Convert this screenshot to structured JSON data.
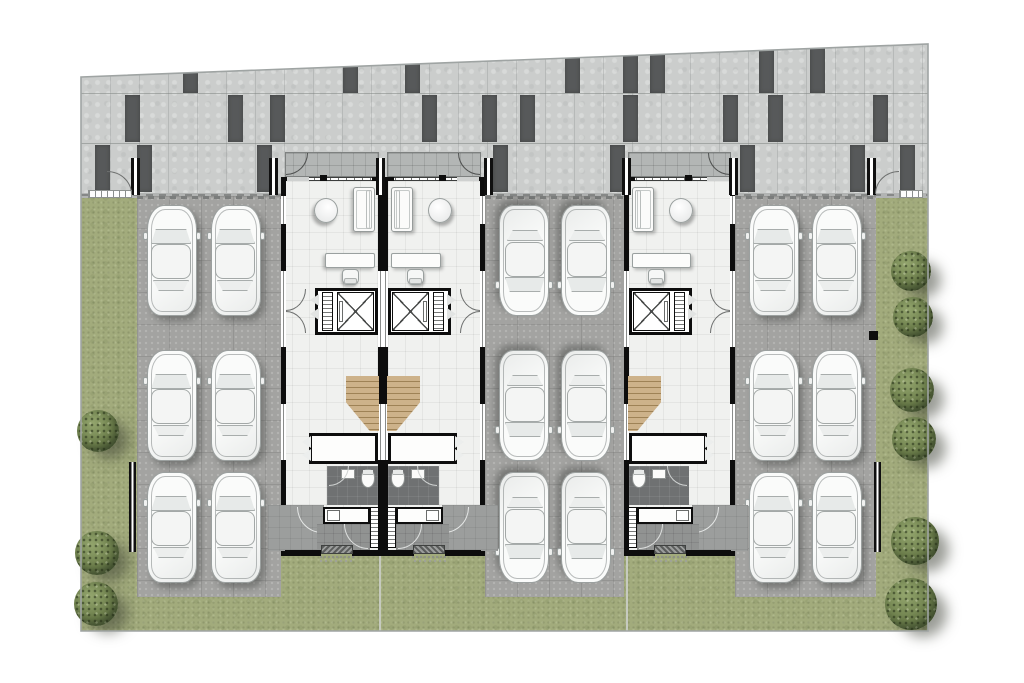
{
  "meta": {
    "title": "Townhome site plan — ground floor with parking",
    "canvas": {
      "width": 1024,
      "height": 683
    },
    "visible_text": []
  },
  "palette": {
    "page_bg": "#ffffff",
    "road": "#cbcdcc",
    "road_dash": "#57595a",
    "grass": "#a2ab7c",
    "parking_pad": "#a3a3a1",
    "building_floor": "#f0f1ef",
    "porch_band": "#b3b6b5",
    "wall_black": "#0d0d0d",
    "wood_stair": "#cdb28a",
    "bathroom_floor": "#6f7172",
    "tree_green": "#6d7f4c",
    "car_body": "#f6f7f6",
    "site_border": "#9fa4a3"
  },
  "site": {
    "polygon": [
      [
        81,
        77
      ],
      [
        928,
        44
      ],
      [
        928,
        631
      ],
      [
        81,
        631
      ]
    ],
    "grass_top": 120,
    "road": {
      "left": 81,
      "right": 928,
      "top_left_y": 77,
      "top_right_y": 44,
      "bottom": 193,
      "joints_y": [
        93,
        143
      ],
      "tile_step": 29,
      "dashes": [
        {
          "x": 183,
          "row": 0
        },
        {
          "x": 343,
          "row": 0
        },
        {
          "x": 405,
          "row": 0
        },
        {
          "x": 565,
          "row": 0
        },
        {
          "x": 623,
          "row": 0
        },
        {
          "x": 650,
          "row": 0
        },
        {
          "x": 759,
          "row": 0
        },
        {
          "x": 810,
          "row": 0
        },
        {
          "x": 125,
          "row": 1
        },
        {
          "x": 228,
          "row": 1
        },
        {
          "x": 270,
          "row": 1
        },
        {
          "x": 422,
          "row": 1
        },
        {
          "x": 482,
          "row": 1
        },
        {
          "x": 520,
          "row": 1
        },
        {
          "x": 623,
          "row": 1
        },
        {
          "x": 723,
          "row": 1
        },
        {
          "x": 768,
          "row": 1
        },
        {
          "x": 873,
          "row": 1
        },
        {
          "x": 95,
          "row": 2
        },
        {
          "x": 137,
          "row": 2
        },
        {
          "x": 257,
          "row": 2
        },
        {
          "x": 493,
          "row": 2
        },
        {
          "x": 610,
          "row": 2
        },
        {
          "x": 740,
          "row": 2
        },
        {
          "x": 850,
          "row": 2
        },
        {
          "x": 900,
          "row": 2
        }
      ],
      "dash_rows": [
        {
          "top": 45,
          "height": 48
        },
        {
          "top": 95,
          "height": 47
        },
        {
          "top": 145,
          "height": 47
        }
      ]
    },
    "curb": {
      "y": 193,
      "height": 5
    }
  },
  "fence": {
    "posts_x": [
      131,
      269,
      376,
      484,
      622,
      729,
      867
    ],
    "wall_segments": [
      {
        "x": 129,
        "y": 462,
        "h": 90
      },
      {
        "x": 874,
        "y": 462,
        "h": 90
      }
    ],
    "black_marker": {
      "x": 869,
      "y": 331,
      "w": 9,
      "h": 9
    },
    "gates": [
      {
        "side": "left",
        "x": 88,
        "width": 44,
        "arc": {
          "x": 107,
          "y": 171,
          "w": 25,
          "h": 23,
          "hinge": "bottom-left"
        }
      },
      {
        "side": "right",
        "x": 899,
        "width": 24,
        "arc": {
          "x": 875,
          "y": 171,
          "w": 24,
          "h": 23,
          "hinge": "bottom-right"
        }
      }
    ]
  },
  "parking_pads": [
    {
      "name": "left-parking-pad",
      "x": 137,
      "y": 196,
      "w": 144,
      "h": 401,
      "car_facing": "up",
      "car_cols": [
        146,
        210
      ],
      "car_rows": [
        204,
        349,
        471
      ]
    },
    {
      "name": "middle-parking-pad",
      "x": 485,
      "y": 196,
      "w": 139,
      "h": 401,
      "car_facing": "down",
      "car_cols": [
        498,
        560
      ],
      "car_rows": [
        204,
        349,
        471
      ]
    },
    {
      "name": "right-parking-pad",
      "x": 735,
      "y": 196,
      "w": 141,
      "h": 401,
      "car_facing": "up",
      "car_cols": [
        748,
        811
      ],
      "car_rows": [
        204,
        349,
        471
      ]
    }
  ],
  "buildings": {
    "duplex": {
      "units": [
        {
          "id": "unit-1",
          "x": 281,
          "y": 152,
          "w": 102,
          "h": 404,
          "mirror": true
        },
        {
          "id": "unit-2",
          "x": 383,
          "y": 152,
          "w": 102,
          "h": 404,
          "mirror": false
        }
      ]
    },
    "single": {
      "units": [
        {
          "id": "unit-3",
          "x": 624,
          "y": 152,
          "w": 111,
          "h": 404,
          "mirror": false
        }
      ]
    },
    "unit_contents": [
      "entry-porch",
      "entry-door-arc",
      "window-wall",
      "sofa",
      "side-table",
      "desk",
      "desk-chair",
      "elevator-shaft",
      "elevator-louver-panel",
      "folding-door",
      "stair",
      "counter-island",
      "bathroom",
      "toilet",
      "bathroom-sink",
      "laundry-panel",
      "laundry-counter",
      "laundry-sink",
      "rear-porch",
      "rear-door-arc",
      "walkway",
      "step-hatch"
    ]
  },
  "landscape": {
    "dividers_x": [
      379,
      626
    ],
    "trees_left": [
      {
        "x": 98,
        "y": 431,
        "r": 21
      },
      {
        "x": 97,
        "y": 553,
        "r": 22
      },
      {
        "x": 96,
        "y": 604,
        "r": 22
      }
    ],
    "trees_right": [
      {
        "x": 911,
        "y": 271,
        "r": 20
      },
      {
        "x": 913,
        "y": 317,
        "r": 20
      },
      {
        "x": 912,
        "y": 390,
        "r": 22
      },
      {
        "x": 914,
        "y": 439,
        "r": 22
      },
      {
        "x": 915,
        "y": 541,
        "r": 24
      },
      {
        "x": 911,
        "y": 604,
        "r": 26
      }
    ]
  }
}
